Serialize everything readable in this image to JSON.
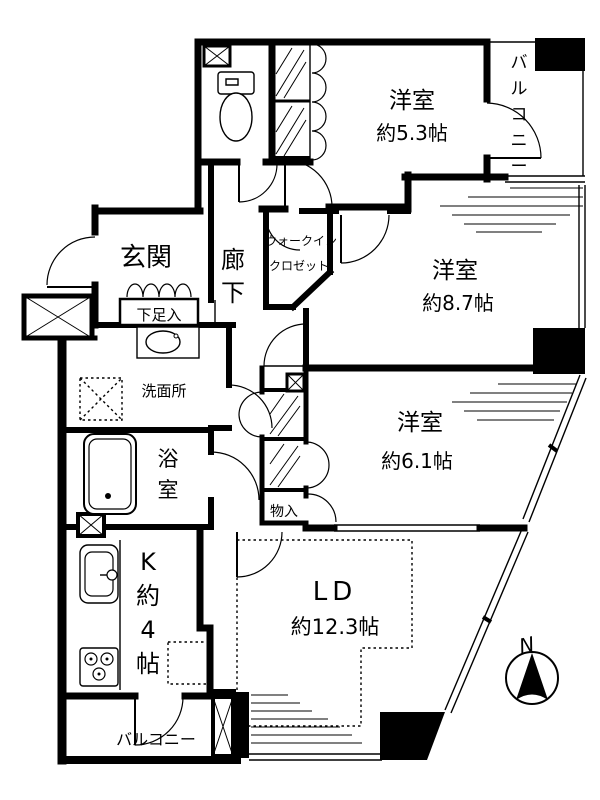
{
  "floorplan": {
    "title": "apartment floor plan",
    "rooms": {
      "bedroom_53": {
        "name": "洋室",
        "size": "約5.3帖"
      },
      "bedroom_87": {
        "name": "洋室",
        "size": "約8.7帖"
      },
      "bedroom_61": {
        "name": "洋室",
        "size": "約6.1帖"
      },
      "living_dining": {
        "name": "LD",
        "size": "約12.3帖"
      },
      "kitchen": {
        "label": "K約4帖"
      },
      "entrance": {
        "label": "玄関"
      },
      "hallway": {
        "label": "廊下"
      },
      "shoe_cabinet": {
        "label": "下足入"
      },
      "washroom": {
        "label": "洗面所"
      },
      "bathroom": {
        "label": "浴室"
      },
      "walk_in_closet": {
        "line1": "ウォークイン",
        "line2": "クロゼット"
      },
      "storage": {
        "label": "物入"
      },
      "floor_heating": {
        "label": "床暖房"
      },
      "balcony_top": {
        "label": "バルコニー"
      },
      "balcony_bottom": {
        "label": "バルコニー"
      }
    },
    "compass": {
      "label": "N"
    },
    "colors": {
      "line": "#000000",
      "background": "#ffffff"
    }
  }
}
